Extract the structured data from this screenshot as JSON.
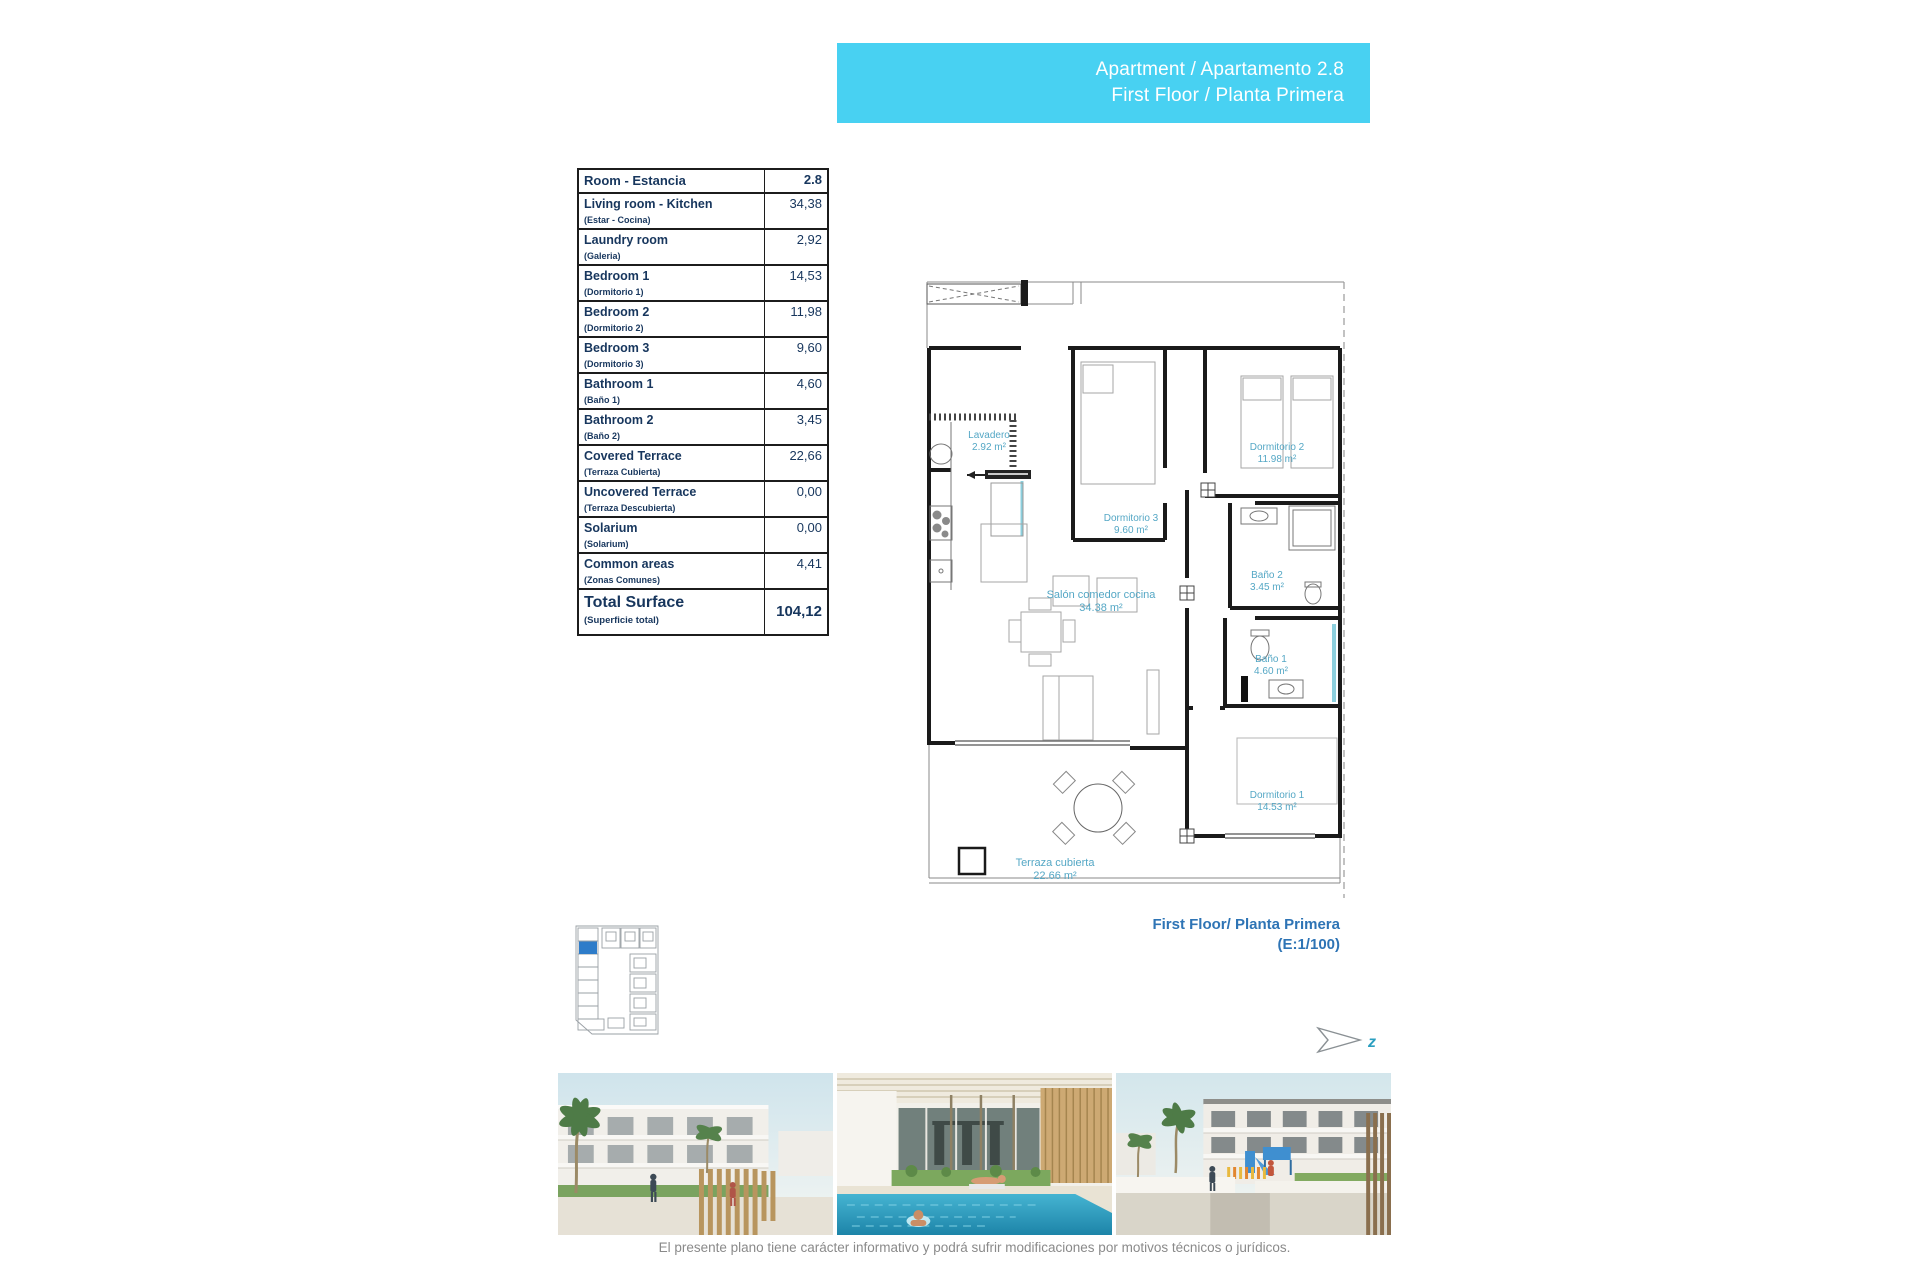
{
  "header": {
    "line1": "Apartment / Apartamento 2.8",
    "line2": "First Floor / Planta Primera",
    "bg_color": "#48d1f2",
    "text_color": "#ffffff"
  },
  "area_table": {
    "header": {
      "label": "Room - Estancia",
      "value": "2.8"
    },
    "rows": [
      {
        "en": "Living room - Kitchen",
        "es": "(Estar - Cocina)",
        "value": "34,38"
      },
      {
        "en": "Laundry room",
        "es": "(Galeria)",
        "value": "2,92"
      },
      {
        "en": "Bedroom 1",
        "es": "(Dormitorio 1)",
        "value": "14,53"
      },
      {
        "en": "Bedroom 2",
        "es": "(Dormitorio 2)",
        "value": "11,98"
      },
      {
        "en": "Bedroom 3",
        "es": "(Dormitorio 3)",
        "value": "9,60"
      },
      {
        "en": "Bathroom 1",
        "es": "(Baño 1)",
        "value": "4,60"
      },
      {
        "en": "Bathroom 2",
        "es": "(Baño 2)",
        "value": "3,45"
      },
      {
        "en": "Covered Terrace",
        "es": "(Terraza Cubierta)",
        "value": "22,66"
      },
      {
        "en": "Uncovered Terrace",
        "es": "(Terraza Descubierta)",
        "value": "0,00"
      },
      {
        "en": "Solarium",
        "es": "(Solarium)",
        "value": "0,00"
      },
      {
        "en": "Common areas",
        "es": "(Zonas Comunes)",
        "value": "4,41"
      }
    ],
    "total": {
      "en": "Total Surface",
      "es": "(Superficie total)",
      "value": "104,12"
    }
  },
  "floor_plan": {
    "rooms": [
      {
        "id": "lavadero",
        "label": "Lavadero",
        "area": "2.92 m²"
      },
      {
        "id": "dormitorio3",
        "label": "Dormitorio 3",
        "area": "9.60 m²"
      },
      {
        "id": "dormitorio2",
        "label": "Dormitorio 2",
        "area": "11.98 m²"
      },
      {
        "id": "bano2",
        "label": "Baño 2",
        "area": "3.45 m²"
      },
      {
        "id": "bano1",
        "label": "Baño 1",
        "area": "4.60 m²"
      },
      {
        "id": "salon",
        "label": "Salón comedor cocina",
        "area": "34.38 m²"
      },
      {
        "id": "dormitorio1",
        "label": "Dormitorio 1",
        "area": "14.53 m²"
      },
      {
        "id": "terraza",
        "label": "Terraza cubierta",
        "area": "22.66 m²"
      }
    ],
    "label_color": "#54a7c5",
    "caption_line1": "First Floor/ Planta Primera",
    "caption_line2": "(E:1/100)",
    "north_label": "z"
  },
  "footer": {
    "disclaimer": "El presente plano tiene carácter informativo y podrá sufrir modificaciones por motivos técnicos o jurídicos."
  },
  "colors": {
    "accent_cyan": "#48d1f2",
    "table_navy": "#17365d",
    "caption_blue": "#2e74b5",
    "plan_label_teal": "#54a7c5",
    "keyplan_unit_blue": "#2e7cc9"
  }
}
